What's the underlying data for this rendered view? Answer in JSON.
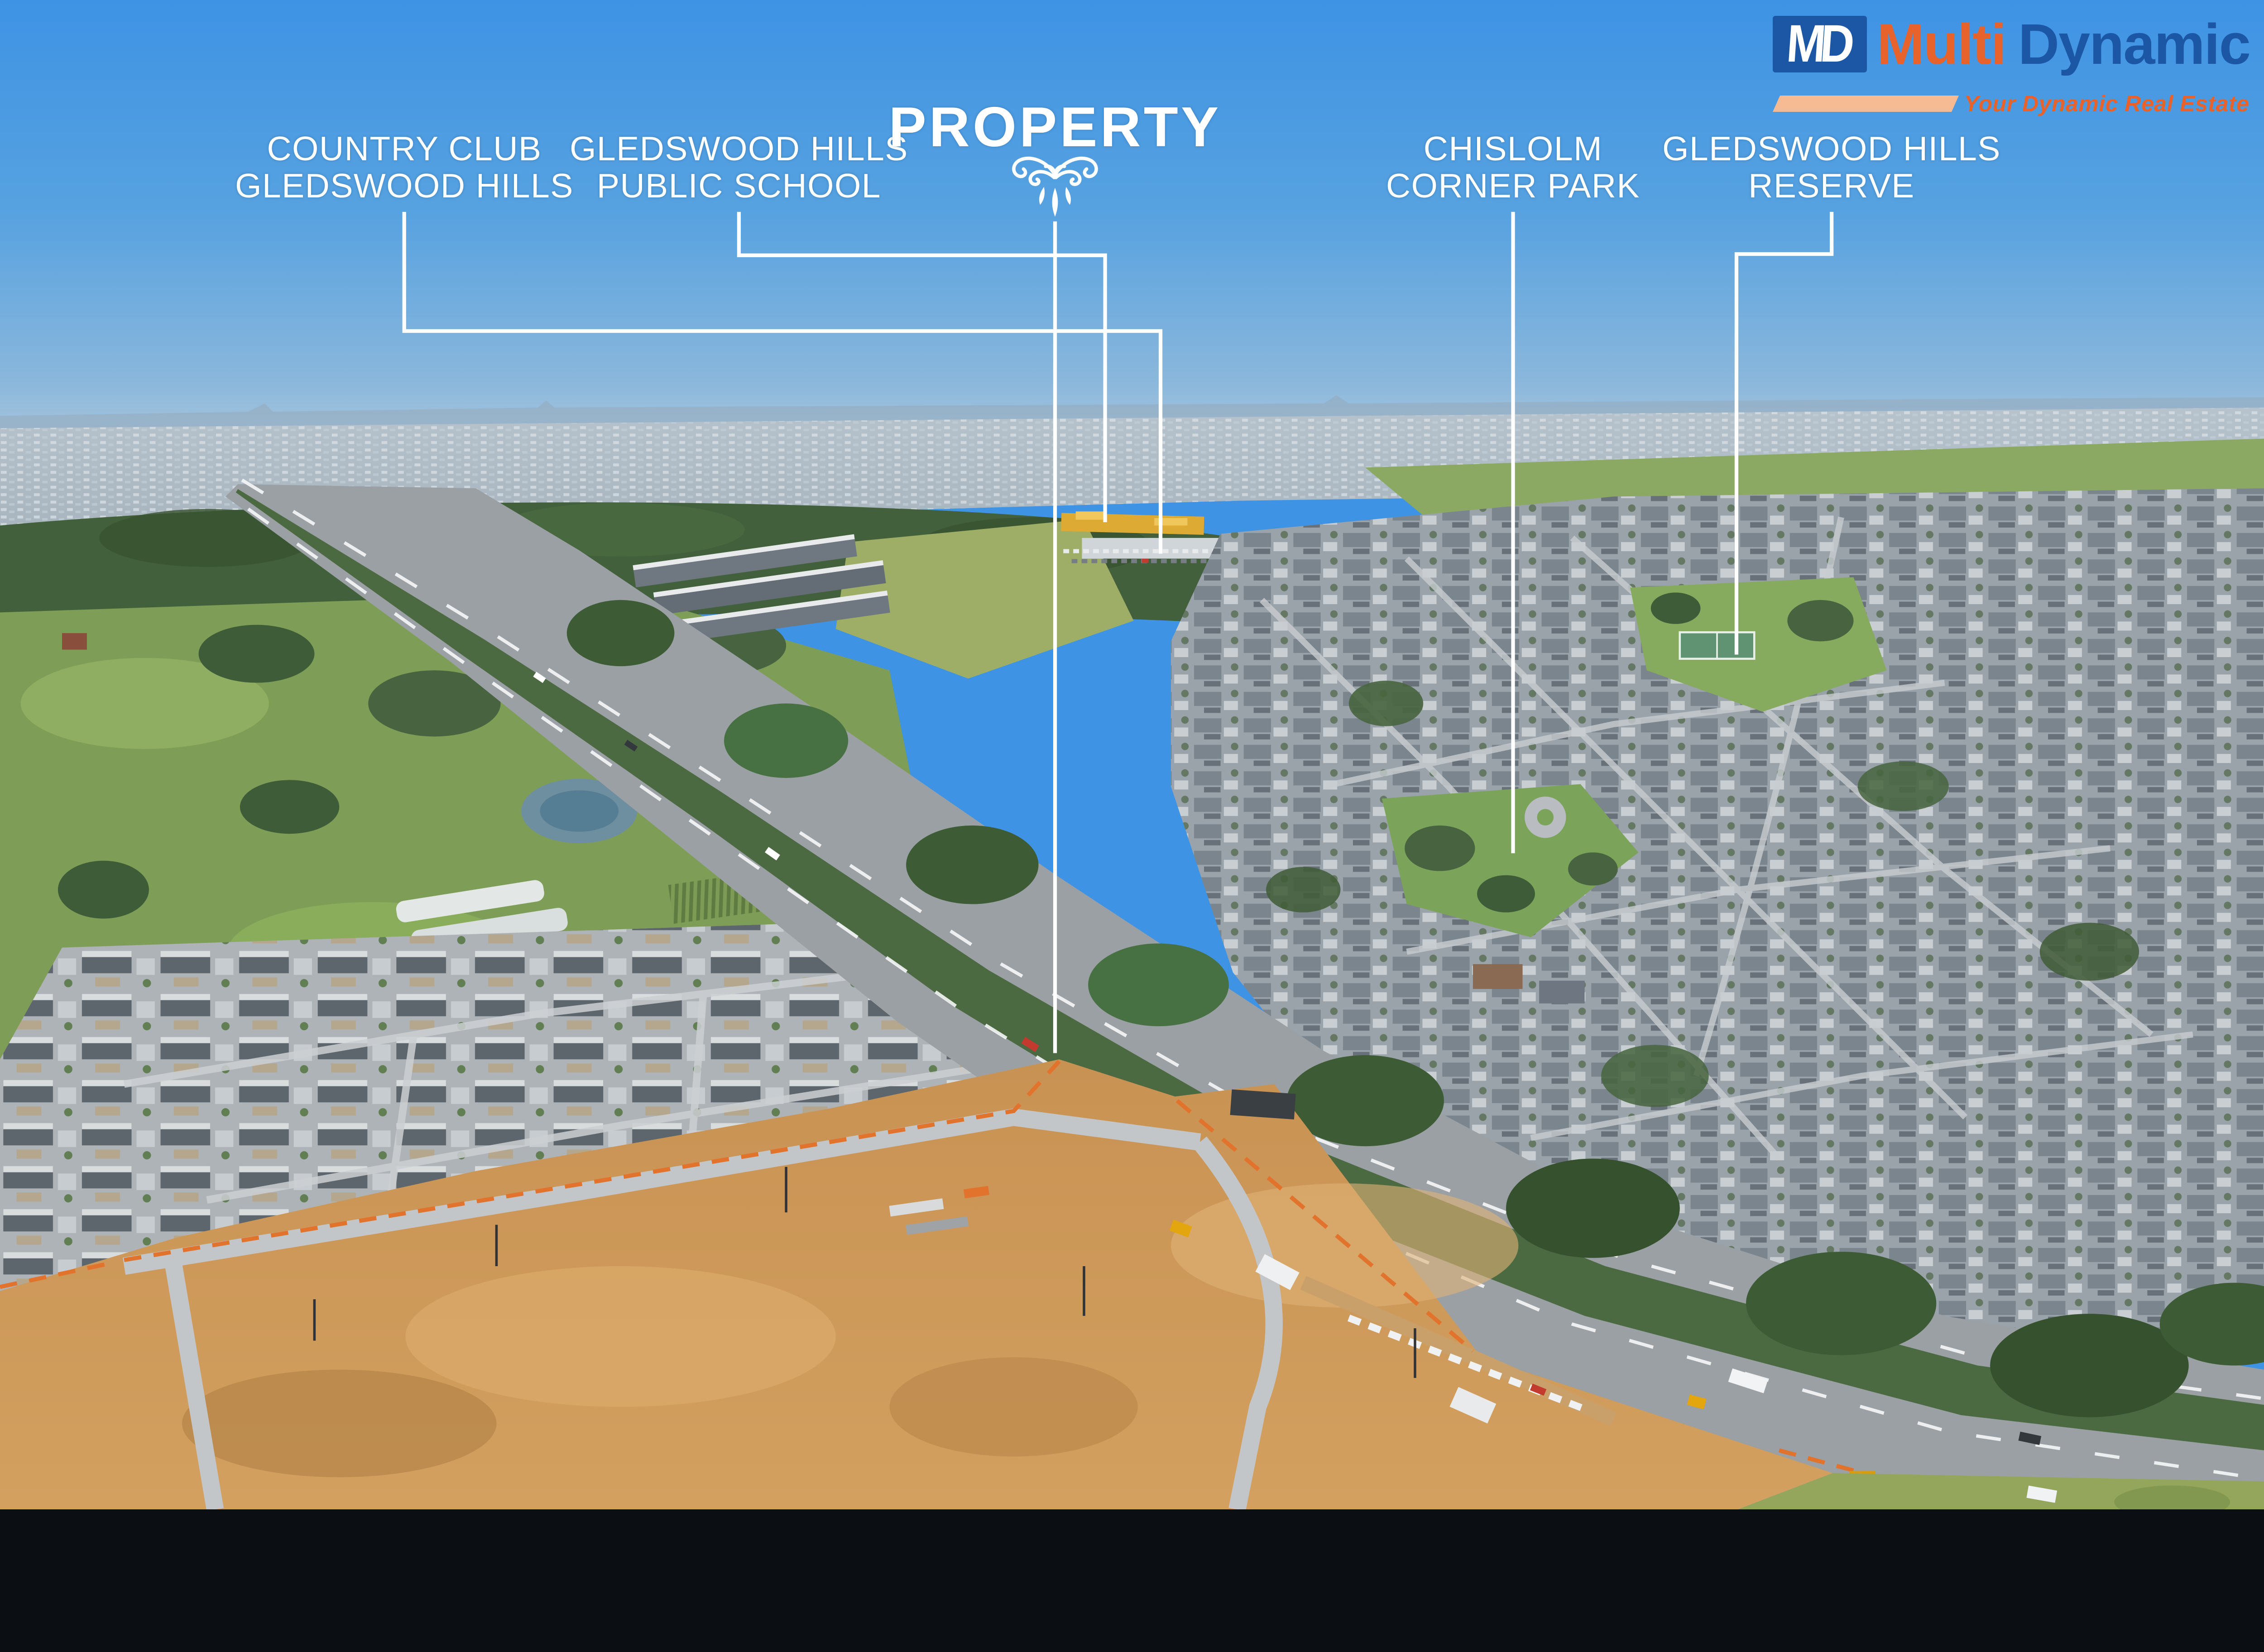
{
  "brand": {
    "monogram": "MD",
    "name_primary": "Multi",
    "name_secondary": "Dynamic",
    "tagline": "Your Dynamic Real Estate"
  },
  "colors": {
    "accent_orange": "#e8622c",
    "brand_blue": "#1b57a4",
    "bar_peach": "#f6bb92",
    "callout_white": "#ffffff",
    "sky_top": "#3e93e4"
  },
  "annotations": {
    "property": {
      "title": "PROPERTY"
    },
    "country_club": {
      "line1": "COUNTRY CLUB",
      "line2": "GLEDSWOOD HILLS"
    },
    "public_school": {
      "line1": "GLEDSWOOD HILLS",
      "line2": "PUBLIC SCHOOL"
    },
    "corner_park": {
      "line1": "CHISLOLM",
      "line2": "CORNER PARK"
    },
    "reserve": {
      "line1": "GLEDSWOOD HILLS",
      "line2": "RESERVE"
    }
  }
}
